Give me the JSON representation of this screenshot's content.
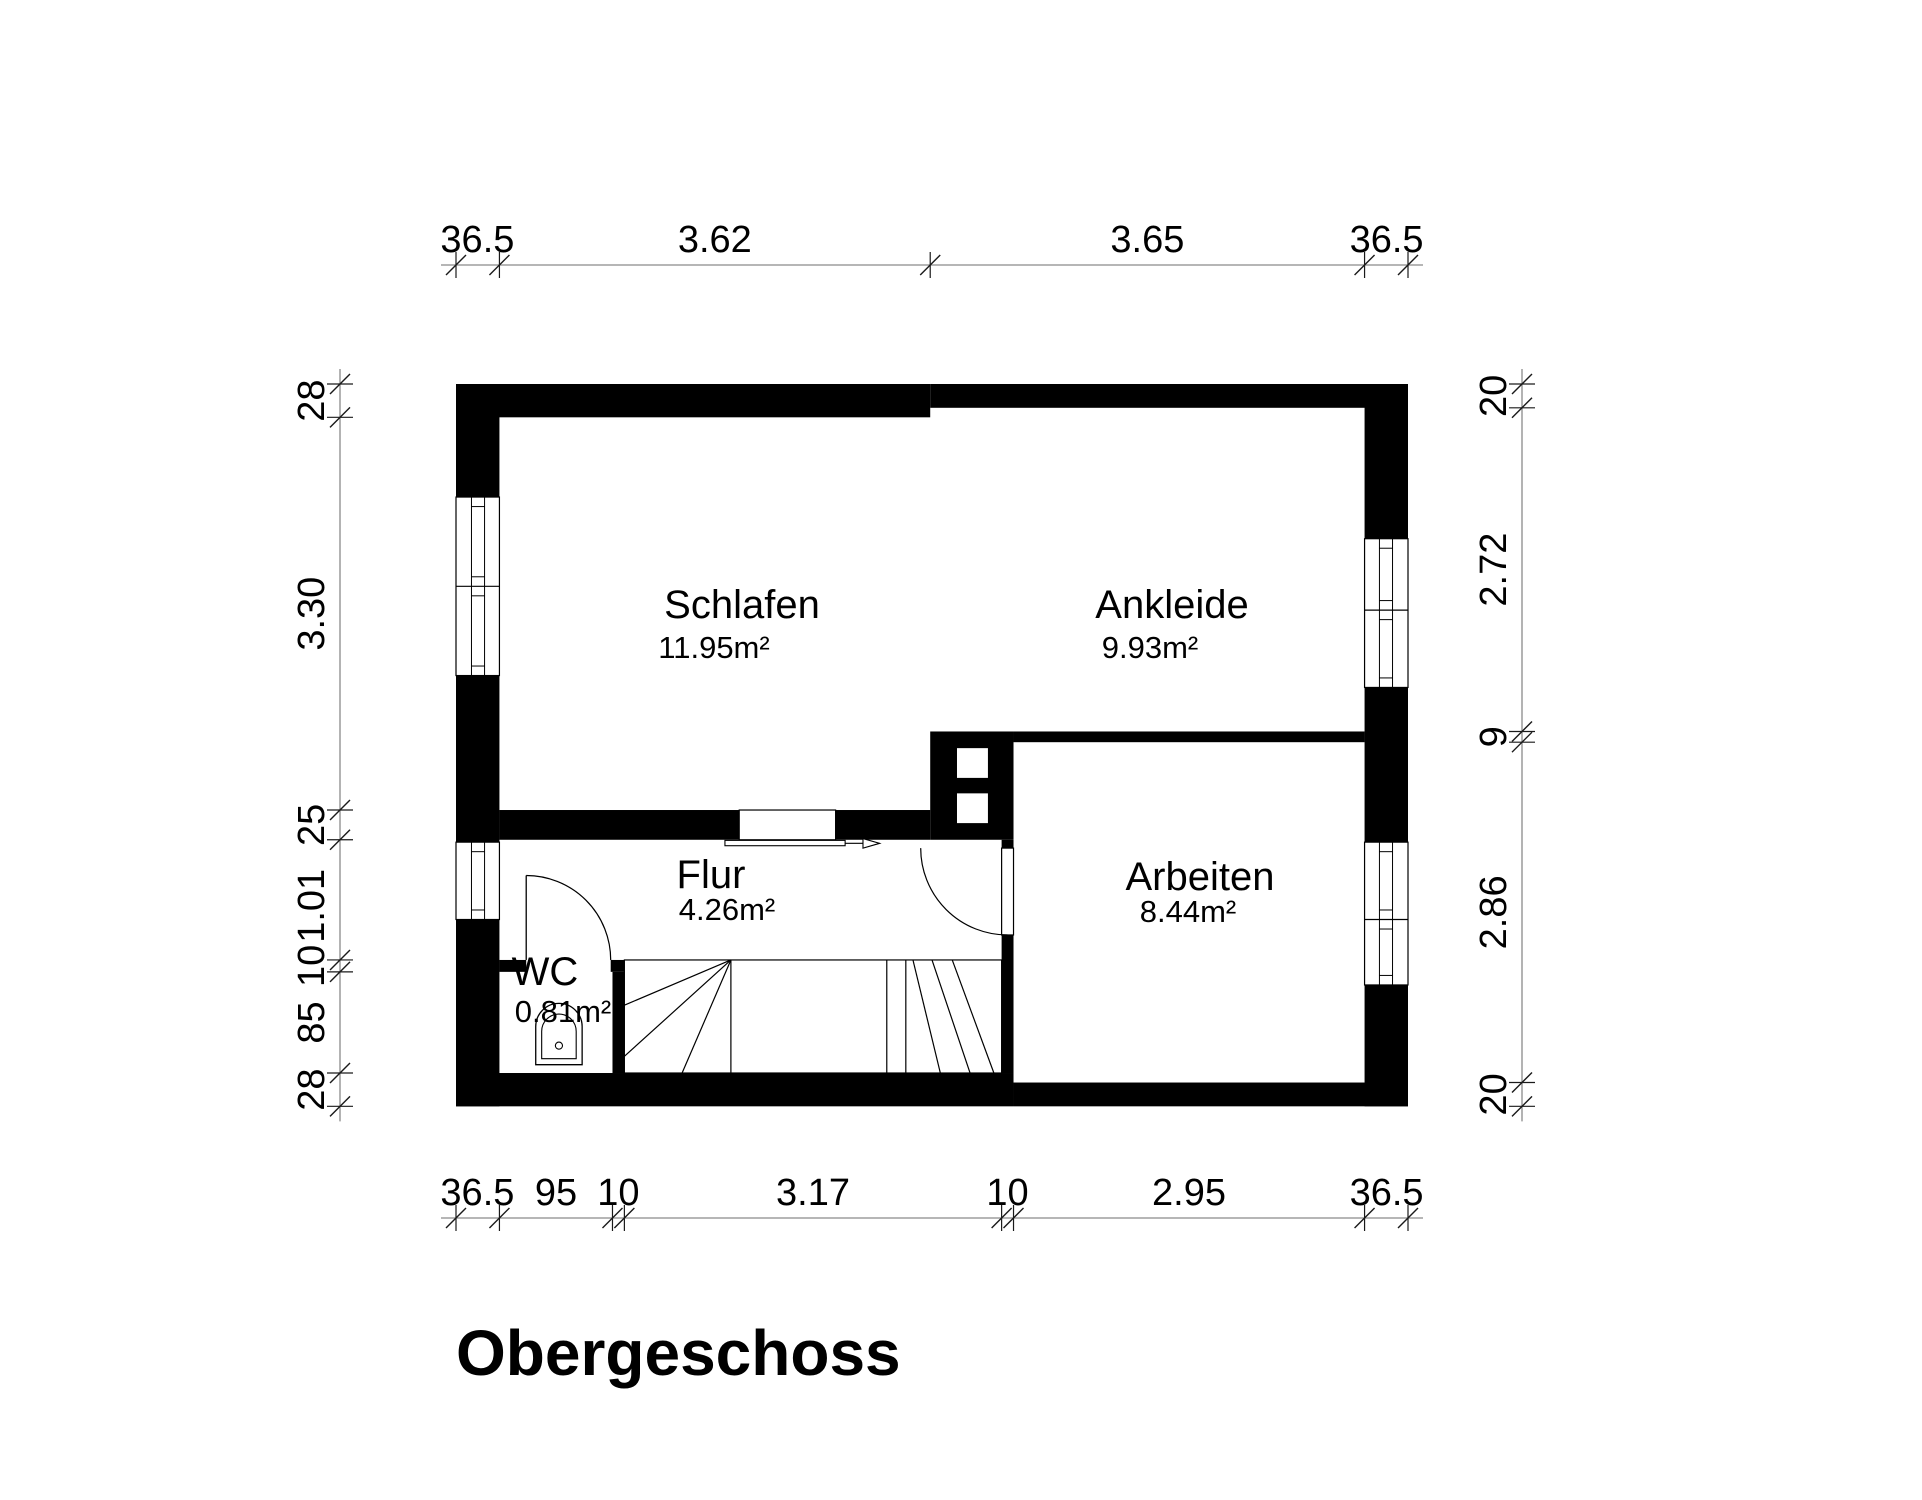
{
  "title": {
    "text": "Obergeschoss"
  },
  "colors": {
    "background": "#ffffff",
    "wall": "#000000",
    "thin_line": "#000000",
    "dim_line": "#8a8a8a",
    "dim_tick": "#1a1a1a",
    "text": "#000000"
  },
  "plan": {
    "origin_px": [
      456,
      384
    ],
    "scale_px_per_cm": 1.19,
    "building_cm": {
      "w": 800,
      "h": 607
    },
    "walls_cm": [
      [
        0,
        0,
        36.5,
        95
      ],
      [
        0,
        245,
        36.5,
        140
      ],
      [
        0,
        450,
        36.5,
        157
      ],
      [
        763.5,
        0,
        36.5,
        130
      ],
      [
        763.5,
        255,
        36.5,
        130
      ],
      [
        763.5,
        505,
        36.5,
        102
      ],
      [
        0,
        0,
        398.5,
        28
      ],
      [
        398.5,
        0,
        401.5,
        20
      ],
      [
        0,
        579,
        468.5,
        28
      ],
      [
        468.5,
        587,
        331.5,
        20
      ],
      [
        36.5,
        358,
        201.5,
        25
      ],
      [
        319,
        358,
        79.5,
        25
      ],
      [
        398.5,
        292,
        70,
        91
      ],
      [
        458.5,
        383,
        10,
        7
      ],
      [
        458.5,
        463,
        10,
        116
      ],
      [
        468.5,
        292,
        295,
        9
      ],
      [
        36.5,
        484,
        22.5,
        10
      ],
      [
        130,
        484,
        11.5,
        10
      ],
      [
        131.5,
        494,
        10,
        85
      ]
    ],
    "niches_cm": [
      [
        421,
        306,
        26,
        25
      ],
      [
        421,
        344,
        26,
        25
      ]
    ],
    "windows": [
      {
        "name": "schlafen-window",
        "side": "left",
        "y1": 95,
        "y2": 245,
        "dividers": [
          170
        ]
      },
      {
        "name": "flur-window",
        "side": "left",
        "y1": 385,
        "y2": 450,
        "dividers": []
      },
      {
        "name": "ankleide-window",
        "side": "right",
        "y1": 130,
        "y2": 255,
        "dividers": [
          190
        ]
      },
      {
        "name": "arbeiten-window",
        "side": "right",
        "y1": 385,
        "y2": 505,
        "dividers": [
          450
        ]
      }
    ],
    "doors": [
      {
        "name": "wc-door",
        "leaf_line": [
          [
            59,
            484
          ],
          [
            59,
            413
          ]
        ],
        "arc": {
          "r": 71,
          "from": [
            59,
            413
          ],
          "to": [
            130,
            484
          ],
          "sweep": 1
        }
      },
      {
        "name": "arbeiten-door",
        "leaf_rect": [
          458.5,
          390,
          10,
          73
        ],
        "arc": {
          "r": 73,
          "from": [
            390.5,
            390
          ],
          "to": [
            463.5,
            463
          ],
          "sweep": 0
        }
      }
    ],
    "sliding_door": {
      "panel_rect": [
        238,
        358,
        81,
        25
      ],
      "bar_rect": [
        226,
        383.5,
        101,
        4.5
      ],
      "line": [
        [
          327,
          386
        ],
        [
          342,
          386
        ]
      ],
      "head": [
        [
          342,
          382
        ],
        [
          356,
          386
        ],
        [
          342,
          390
        ]
      ]
    },
    "stairs": {
      "outline_cm": [
        141.5,
        484,
        317,
        95
      ],
      "lines_cm": [
        [
          [
            231,
            484
          ],
          [
            231,
            579
          ]
        ],
        [
          [
            362,
            484
          ],
          [
            362,
            579
          ]
        ],
        [
          [
            378,
            484
          ],
          [
            378,
            579
          ]
        ],
        [
          [
            231,
            484
          ],
          [
            141.5,
            522
          ]
        ],
        [
          [
            231,
            484
          ],
          [
            141.5,
            565
          ]
        ],
        [
          [
            231,
            484
          ],
          [
            190,
            579
          ]
        ],
        [
          [
            384,
            484
          ],
          [
            407,
            579
          ]
        ],
        [
          [
            400,
            484
          ],
          [
            432,
            579
          ]
        ],
        [
          [
            417,
            484
          ],
          [
            452,
            579
          ]
        ]
      ]
    },
    "toilet": {
      "outer_path": "M 67 572 L 67 540 A 19.5 19.5 0 0 1 106 540 L 106 572 Z",
      "inner_path": "M 72 567 L 72 544 A 14.5 14.5 0 0 1 101 544 L 101 567 Z",
      "button": {
        "cx": 86.5,
        "cy": 556,
        "r": 3
      }
    },
    "rooms": [
      {
        "id": "schlafen",
        "name": "Schlafen",
        "area": "11.95m²",
        "name_px": [
          742,
          618
        ],
        "area_px": [
          714,
          658
        ]
      },
      {
        "id": "ankleide",
        "name": "Ankleide",
        "area": "9.93m²",
        "name_px": [
          1172,
          618
        ],
        "area_px": [
          1150,
          658
        ]
      },
      {
        "id": "flur",
        "name": "Flur",
        "area": "4.26m²",
        "name_px": [
          711,
          888
        ],
        "area_px": [
          727,
          920
        ]
      },
      {
        "id": "arbeiten",
        "name": "Arbeiten",
        "area": "8.44m²",
        "name_px": [
          1200,
          890
        ],
        "area_px": [
          1188,
          922
        ]
      },
      {
        "id": "wc",
        "name": "WC",
        "area": "0.81m²",
        "name_px": [
          545,
          985
        ],
        "area_px": [
          563,
          1022
        ]
      }
    ],
    "dim_chains": [
      {
        "id": "top",
        "orientation": "h",
        "line_px": 265,
        "boundaries_cm": [
          0,
          36.5,
          398.5,
          763.5,
          800
        ],
        "labels": [
          {
            "text": "36.5",
            "center_cm": 18
          },
          {
            "text": "3.62",
            "center_cm": 217.5
          },
          {
            "text": "3.65",
            "center_cm": 581
          },
          {
            "text": "36.5",
            "center_cm": 782
          }
        ]
      },
      {
        "id": "bottom",
        "orientation": "h",
        "line_px": 1218,
        "boundaries_cm": [
          0,
          36.5,
          131.5,
          141.5,
          458.5,
          468.5,
          763.5,
          800
        ],
        "labels": [
          {
            "text": "36.5",
            "center_cm": 18
          },
          {
            "text": "95",
            "center_cm": 84
          },
          {
            "text": "10",
            "center_cm": 136.5
          },
          {
            "text": "3.17",
            "center_cm": 300
          },
          {
            "text": "10",
            "center_cm": 463.5
          },
          {
            "text": "2.95",
            "center_cm": 616
          },
          {
            "text": "36.5",
            "center_cm": 782
          }
        ]
      },
      {
        "id": "left",
        "orientation": "v",
        "line_px": 340,
        "boundaries_cm": [
          0,
          28,
          358,
          383,
          484,
          494,
          579,
          607
        ],
        "labels": [
          {
            "text": "28",
            "center_cm": 14
          },
          {
            "text": "3.30",
            "center_cm": 193
          },
          {
            "text": "25",
            "center_cm": 370.5
          },
          {
            "text": "1.01",
            "center_cm": 438.5
          },
          {
            "text": "10",
            "center_cm": 489
          },
          {
            "text": "85",
            "center_cm": 536.5
          },
          {
            "text": "28",
            "center_cm": 593
          }
        ]
      },
      {
        "id": "right",
        "orientation": "v",
        "line_px": 1522,
        "boundaries_cm": [
          0,
          20,
          292,
          301,
          587,
          607
        ],
        "labels": [
          {
            "text": "20",
            "center_cm": 10
          },
          {
            "text": "2.72",
            "center_cm": 156
          },
          {
            "text": "9",
            "center_cm": 296.5
          },
          {
            "text": "2.86",
            "center_cm": 444
          },
          {
            "text": "20",
            "center_cm": 597
          }
        ]
      }
    ]
  }
}
